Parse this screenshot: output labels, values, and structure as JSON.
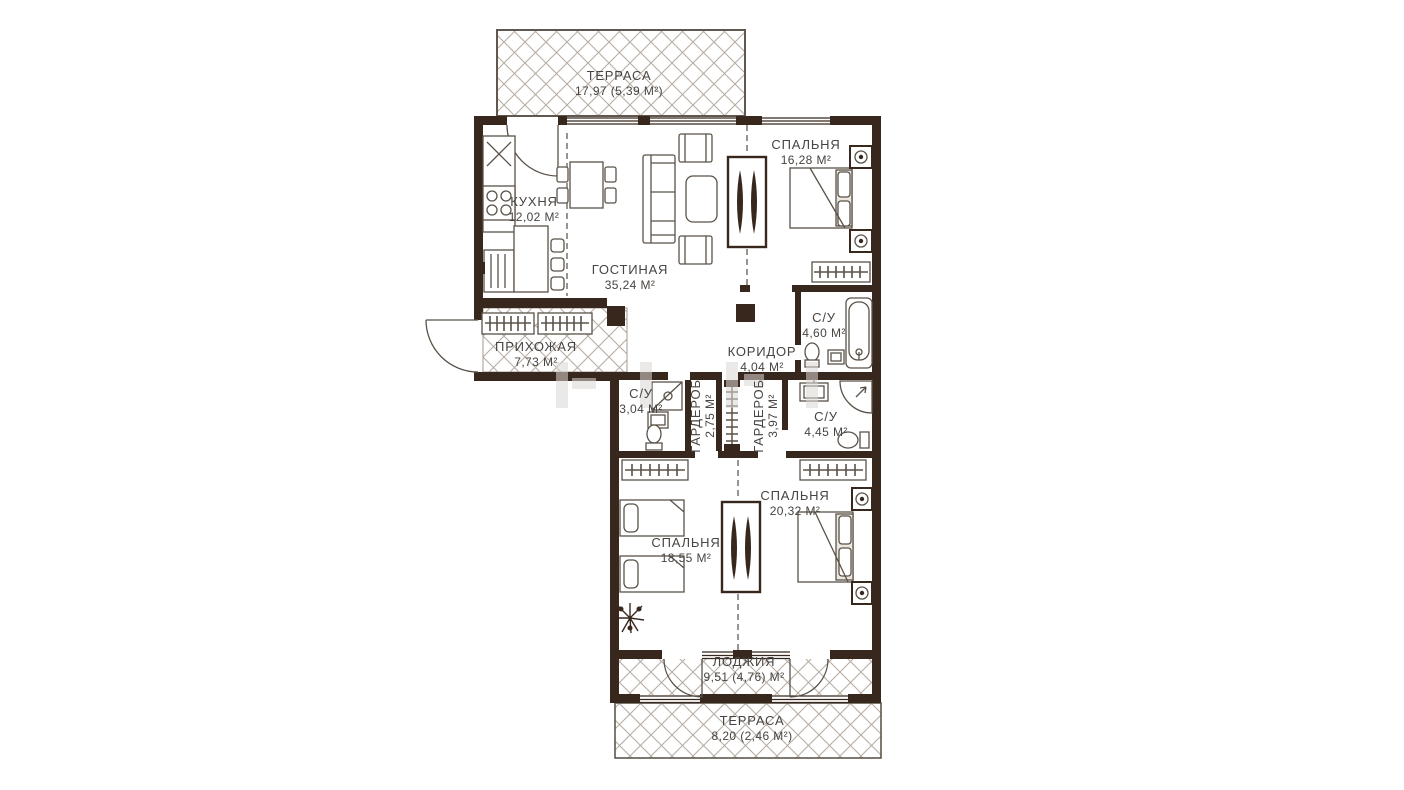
{
  "plan": {
    "rooms": [
      {
        "key": "terrace-top",
        "name": "ТЕРРАСА",
        "area": "17,97 (5,39 М²)"
      },
      {
        "key": "bedroom-1",
        "name": "СПАЛЬНЯ",
        "area": "16,28 М²"
      },
      {
        "key": "kitchen",
        "name": "КУХНЯ",
        "area": "12,02 М²"
      },
      {
        "key": "living-room",
        "name": "ГОСТИНАЯ",
        "area": "35,24 М²"
      },
      {
        "key": "hallway",
        "name": "ПРИХОЖАЯ",
        "area": "7,73 М²"
      },
      {
        "key": "corridor",
        "name": "КОРИДОР",
        "area": "4,04 М²"
      },
      {
        "key": "bathroom-1",
        "name": "С/У",
        "area": "4,60 М²"
      },
      {
        "key": "bathroom-2",
        "name": "С/У",
        "area": "3,04 М²"
      },
      {
        "key": "wardrobe-1",
        "name": "ГАРДЕРОБ",
        "area": "2,75 М²"
      },
      {
        "key": "wardrobe-2",
        "name": "ГАРДЕРОБ",
        "area": "3,97 М²"
      },
      {
        "key": "bathroom-3",
        "name": "С/У",
        "area": "4,45 М²"
      },
      {
        "key": "bedroom-2",
        "name": "СПАЛЬНЯ",
        "area": "20,32 М²"
      },
      {
        "key": "bedroom-3",
        "name": "СПАЛЬНЯ",
        "area": "18,55 М²"
      },
      {
        "key": "loggia",
        "name": "ЛОДЖИЯ",
        "area": "9,51 (4,76) М²"
      },
      {
        "key": "terrace-bottom",
        "name": "ТЕРРАСА",
        "area": "8,20 (2,46 М²)"
      }
    ],
    "colors": {
      "wall": "#38271d",
      "line": "#5a5248",
      "hatch": "#b7ada3",
      "text": "#474441",
      "background": "#ffffff"
    }
  }
}
